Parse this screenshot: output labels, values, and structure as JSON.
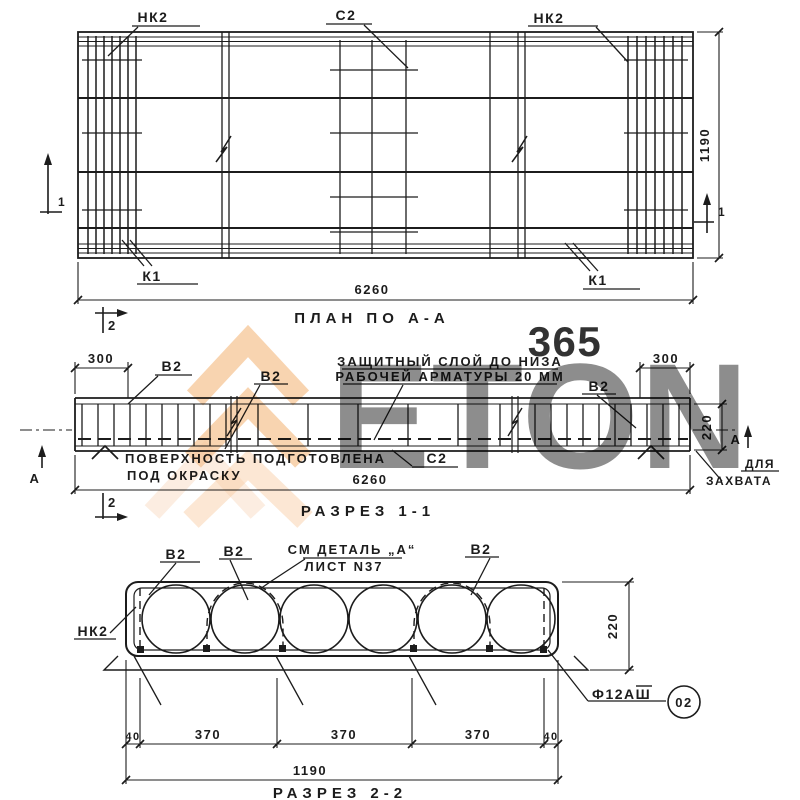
{
  "watermark": {
    "digits": "365",
    "letters": "ETON",
    "accent_color": "#f2a963",
    "digits_color": "#f6b68a",
    "letters_color": "#dedede"
  },
  "plan": {
    "title": "ПЛАН ПО А-А",
    "label_nk2": "НК2",
    "label_c2": "С2",
    "label_k1": "К1",
    "dim_length": "6260",
    "dim_width": "1190",
    "cut_1": "1",
    "cut_2": "2"
  },
  "section_1_1": {
    "title": "РАЗРЕЗ 1-1",
    "label_b2": "В2",
    "label_c2": "С2",
    "dim_end": "300",
    "dim_length": "6260",
    "dim_depth": "220",
    "view_mark_a": "А",
    "cut_2": "2",
    "note_cover_line1": "ЗАЩИТНЫЙ СЛОЙ ДО НИЗА",
    "note_cover_line2": "РАБОЧЕЙ АРМАТУРЫ 20 ММ",
    "note_surface_line1": "ПОВЕРХНОСТЬ ПОДГОТОВЛЕНА",
    "note_surface_line2": "ПОД ОКРАСКУ",
    "note_grip_line1": "ДЛЯ",
    "note_grip_line2": "ЗАХВАТА"
  },
  "section_2_2": {
    "title": "РАЗРЕЗ 2-2",
    "label_b2": "В2",
    "label_nk2": "НК2",
    "note_detail_line1": "СМ ДЕТАЛЬ „А“",
    "note_detail_line2": "ЛИСТ N37",
    "label_rebar": "Ф12АШ",
    "position_badge": "02",
    "dim_edge": "40",
    "dim_span": "370",
    "dim_width": "1190",
    "dim_depth": "220"
  }
}
